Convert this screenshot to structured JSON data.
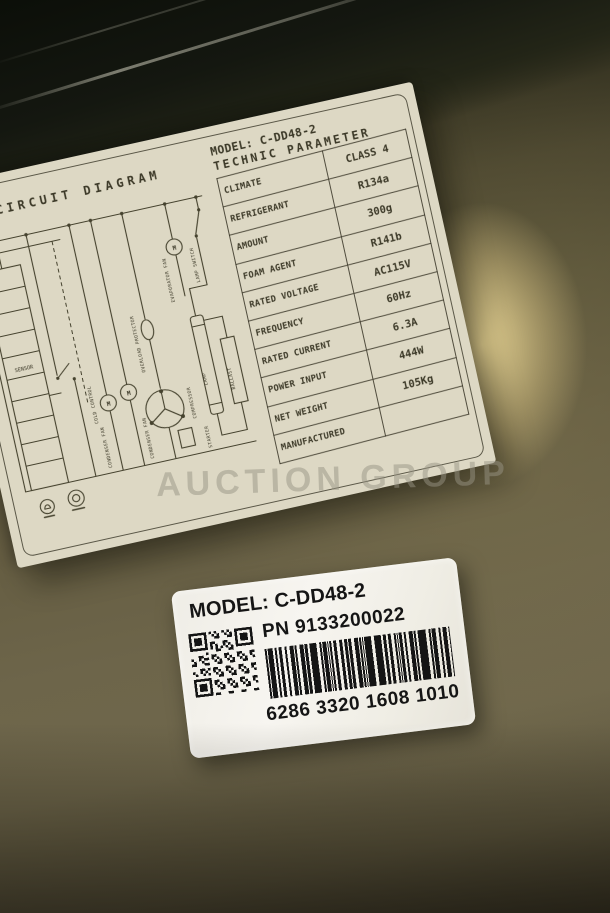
{
  "photo": {
    "watermark_text": "AUCTION GROUP",
    "colors": {
      "steel_dark": "#1d1f13",
      "steel_olive": "#655d42",
      "warm_glow": "#eeda98",
      "paper": "#e9e5d3",
      "ink": "#3c3928",
      "sticker_white": "#f4f2ec",
      "sticker_text": "#151515"
    }
  },
  "circuit_label": {
    "diagram_title": "CIRCUIT DIAGRAM",
    "model_line": "MODEL: C-DD48-2",
    "table_title": "TECHNIC PARAMETER",
    "parameters": [
      {
        "label": "CLIMATE",
        "value": "CLASS 4"
      },
      {
        "label": "REFRIGERANT",
        "value": "R134a"
      },
      {
        "label": "AMOUNT",
        "value": "300g"
      },
      {
        "label": "FOAM AGENT",
        "value": "R141b"
      },
      {
        "label": "RATED VOLTAGE",
        "value": "AC115V"
      },
      {
        "label": "FREQUENCY",
        "value": "60Hz"
      },
      {
        "label": "RATED CURRENT",
        "value": "6.3A"
      },
      {
        "label": "POWER INPUT",
        "value": "444W"
      },
      {
        "label": "NET WEIGHT",
        "value": "105Kg"
      },
      {
        "label": "MANUFACTURED",
        "value": ""
      }
    ],
    "components": {
      "sensor": "SENSOR",
      "cold_control": "COLD CONTROL",
      "condenser_fan_1": "CONDENSER FAN",
      "condenser_fan_2": "CONDENSER FAN",
      "overload_protector": "OVERLOAD PROTECTOR",
      "compressor": "COMPRESSOR",
      "starter": "STARTER",
      "evaporator_fan": "EVAPORATOR FAN",
      "lamp_switch": "LAMP SWITCH",
      "lamp": "LAMP",
      "ballast": "BALLAST",
      "motor_letter": "M"
    }
  },
  "barcode_sticker": {
    "model_line": "MODEL: C-DD48-2",
    "pn_line": "PN 9133200022",
    "barcode_digits": "6286 3320 1608 1010"
  }
}
